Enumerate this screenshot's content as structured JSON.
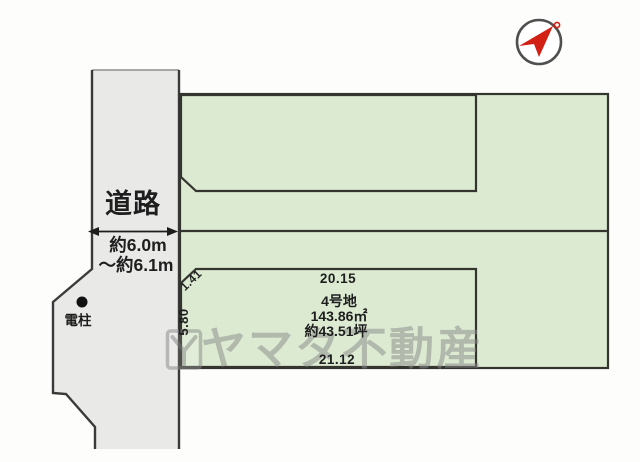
{
  "diagram_type": "land-plot-layout",
  "compass": {
    "icon": "north-arrow"
  },
  "road": {
    "label": "道路",
    "width_note_line1": "約6.0m",
    "width_note_line2": "〜約6.1m",
    "pole_label": "電柱"
  },
  "lot4": {
    "name": "4号地",
    "area_sqm": "143.86㎡",
    "area_tsubo": "約43.51坪",
    "dim_top": "20.15",
    "dim_bottom": "21.12",
    "dim_left": "5.80",
    "dim_corner": "1.41"
  },
  "watermark": {
    "text": "ヤマタ不動産"
  },
  "colors": {
    "parcel_green": "#dcead2",
    "road_gray": "#e9e9e8",
    "outline_dark": "#34352f",
    "compass_red": "#d32015",
    "watermark_gray": "#8b8b8b"
  }
}
